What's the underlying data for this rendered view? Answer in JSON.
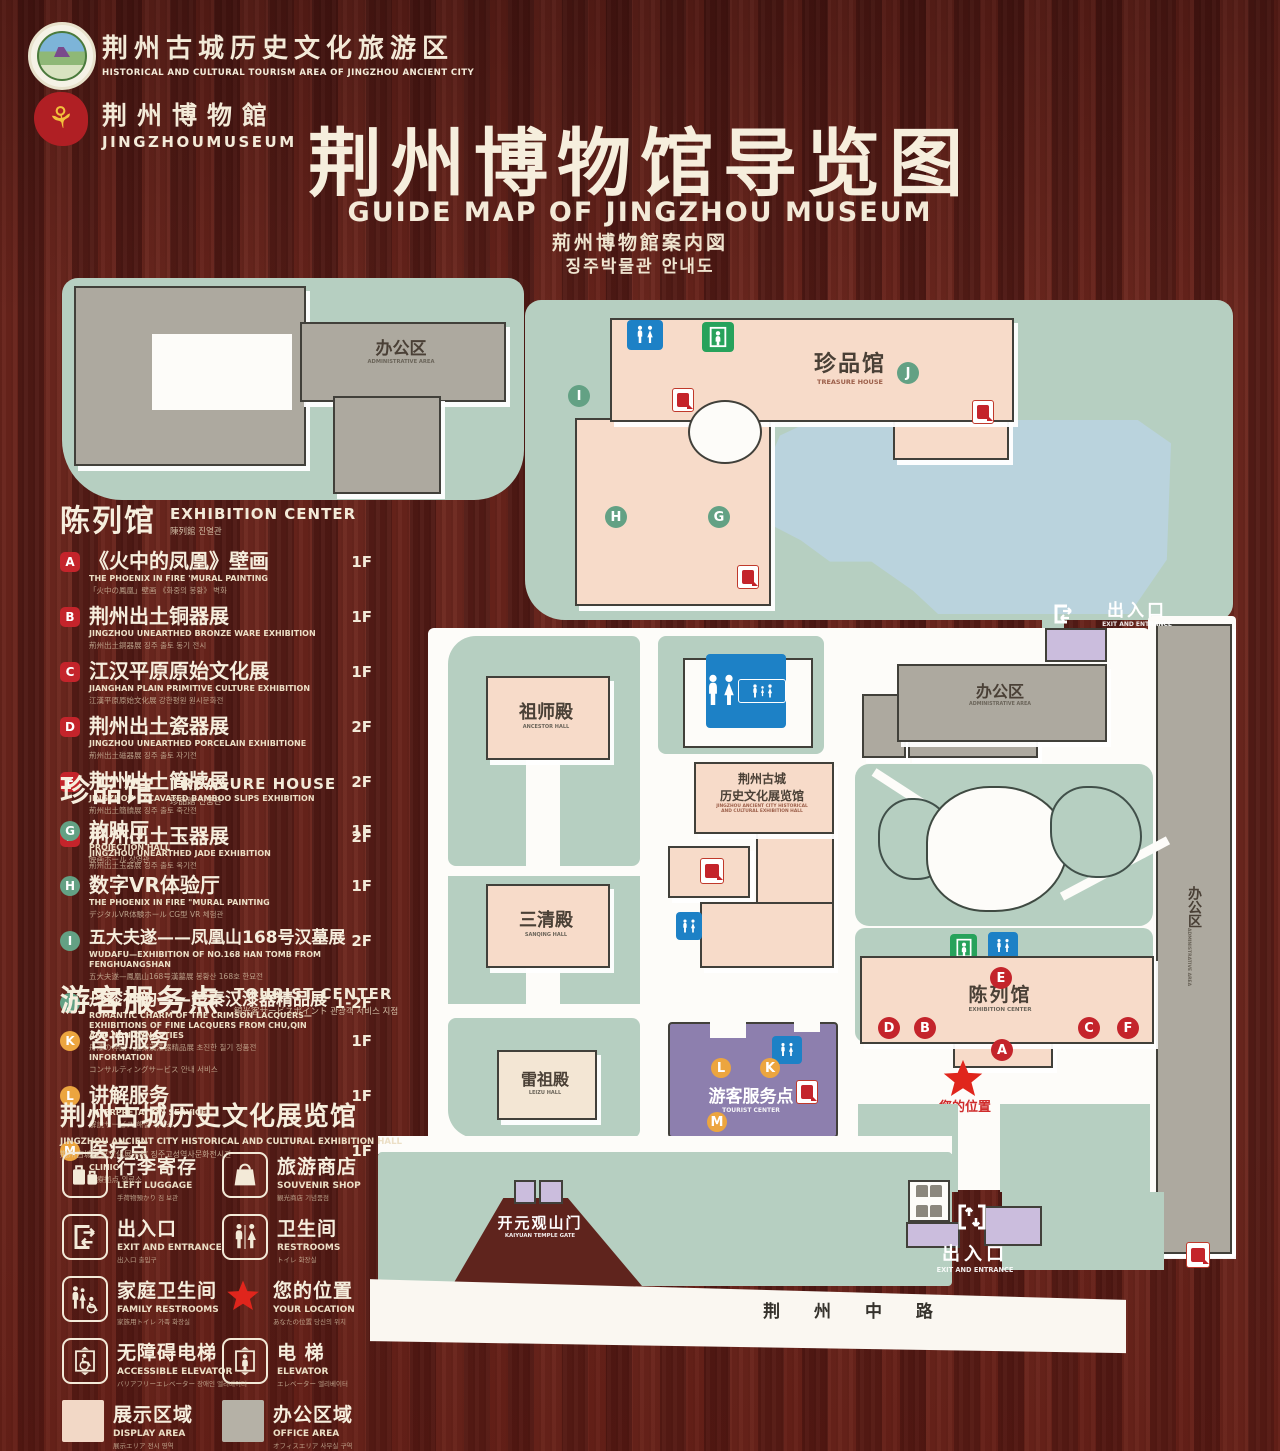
{
  "header": {
    "logo1": {
      "zh": "荆州古城历史文化旅游区",
      "en": "HISTORICAL AND CULTURAL TOURISM AREA OF JINGZHOU ANCIENT CITY"
    },
    "logo2": {
      "zh": "荆州博物館",
      "en": "JINGZHOUMUSEUM"
    },
    "title_zh": "荆州博物馆导览图",
    "title_en": "GUIDE MAP OF JINGZHOU MUSEUM",
    "title_ja": "荊州博物館案内図",
    "title_ko": "징주박물관 안내도"
  },
  "sidebar": {
    "sections": [
      {
        "zh": "陈列馆",
        "en": "EXHIBITION CENTER",
        "sub": "陳列館  진열관",
        "items": [
          {
            "id": "A",
            "zh": "《火中的凤凰》壁画",
            "en": "THE PHOENIX IN FIRE 'MURAL PAINTING",
            "sub": "「火中の鳳凰」壁画 《화중의 봉황》 벽화",
            "floor": "1F"
          },
          {
            "id": "B",
            "zh": "荆州出土铜器展",
            "en": "JINGZHOU UNEARTHED BRONZE WARE EXHIBITION",
            "sub": "荊州出土銅器展  징주 출토 동기 전시",
            "floor": "1F"
          },
          {
            "id": "C",
            "zh": "江汉平原原始文化展",
            "en": "JIANGHAN PLAIN PRIMITIVE CULTURE EXHIBITION",
            "sub": "江漢平原原始文化展  강한평원 원시문화전",
            "floor": "1F"
          },
          {
            "id": "D",
            "zh": "荆州出土瓷器展",
            "en": "JINGZHOU UNEARTHED PORCELAIN EXHIBITIONE",
            "sub": "荊州出土磁器展  징주 출토 자기전",
            "floor": "2F"
          },
          {
            "id": "E",
            "zh": "荆州出土简牍展",
            "en": "JINGZHOU EXCAVATED BAMBOO SLIPS EXHIBITION",
            "sub": "荊州出土簡牘展  징주 출토 죽간전",
            "floor": "2F"
          },
          {
            "id": "F",
            "zh": "荆州出土玉器展",
            "en": "JINGZHOU UNEARTHED JADE EXHIBITION",
            "sub": "荊州出土玉器展  징주 출토 옥기전",
            "floor": "2F"
          }
        ]
      },
      {
        "zh": "珍品馆",
        "en": "TREASURE HOUSE",
        "sub": "珍品館  진품관",
        "items": [
          {
            "id": "G",
            "zh": "放映厅",
            "en": "PROJECTION HALL",
            "sub": "映画ホール  상영관",
            "floor": "1F"
          },
          {
            "id": "H",
            "zh": "数字VR体验厅",
            "en": "THE PHOENIX IN FIRE \"MURAL PAINTING",
            "sub": "デジタルVR体験ホール  CG型 VR 체험관",
            "floor": "1F"
          },
          {
            "id": "I",
            "zh": "五大夫遂——凤凰山168号汉墓展",
            "en": "WUDAFU—EXHIBITION OF NO.168 HAN TOMB FROM FENGHUANGSHAN",
            "sub": "五大夫遂—鳳凰山168号漢墓展  봉황산 168호 한묘전",
            "floor": "2F"
          },
          {
            "id": "J",
            "zh": "丹漆神韵——楚秦汉漆器精品展",
            "en": "ROMANTIC CHARM OF THE CRIMSON LACQUERS— EXHIBITIONS OF FINE LACQUERS FROM CHU,QIN AND HAN DYNASTIES",
            "sub": "丹漆の神韻—楚秦漢漆器精品展  초진한 칠기 정품전",
            "floor": "1-2F"
          }
        ]
      },
      {
        "zh": "游客服务点",
        "en": "TOURIST CENTER",
        "sub": "観光客サービスポイント  관광객 서비스 지점",
        "items": [
          {
            "id": "K",
            "zh": "咨询服务",
            "en": "INFORMATION",
            "sub": "コンサルティングサービス  안내 서비스",
            "floor": "1F"
          },
          {
            "id": "L",
            "zh": "讲解服务",
            "en": "INTERPRETATION SERVICE",
            "sub": "解説サービス  해설 서비스",
            "floor": "1F"
          },
          {
            "id": "M",
            "zh": "医疗点",
            "en": "CLINIC",
            "sub": "医療拠点  의료소",
            "floor": "1F"
          }
        ]
      }
    ],
    "hall_note": {
      "zh": "荆州古城历史文化展览馆",
      "en": "JINGZHOU ANCIENT CITY HISTORICAL AND CULTURAL EXHIBITION HALL",
      "sub": "荆州古城歴史文化展示館    징주고성역사문화전시관"
    },
    "legend": [
      {
        "zh": "行李寄存",
        "en": "LEFT LUGGAGE",
        "sub": "手荷物預かり  짐 보관"
      },
      {
        "zh": "旅游商店",
        "en": "SOUVENIR SHOP",
        "sub": "観光商店  기념품점"
      },
      {
        "zh": "出入口",
        "en": "EXIT AND ENTRANCE",
        "sub": "出入口  출입구"
      },
      {
        "zh": "卫生间",
        "en": "RESTROOMS",
        "sub": "トイレ  화장실"
      },
      {
        "zh": "家庭卫生间",
        "en": "FAMILY RESTROOMS",
        "sub": "家族用トイレ  가족 화장실"
      },
      {
        "zh": "您的位置",
        "en": "YOUR LOCATION",
        "sub": "あなたの位置  당신의 위치"
      },
      {
        "zh": "无障碍电梯",
        "en": "ACCESSIBLE ELEVATOR",
        "sub": "バリアフリーエレベーター  장애인 엘리베이터"
      },
      {
        "zh": "电  梯",
        "en": "ELEVATOR",
        "sub": "エレベーター  엘리베이터"
      },
      {
        "zh": "展示区域",
        "en": "DISPLAY AREA",
        "sub": "展示エリア  전시 영역"
      },
      {
        "zh": "办公区域",
        "en": "OFFICE AREA",
        "sub": "オフィスエリア  사무실 구역"
      }
    ]
  },
  "map": {
    "admin": {
      "zh": "办公区",
      "en": "ADMINISTRATIVE AREA"
    },
    "treasure_house": {
      "zh": "珍品馆",
      "en": "TREASURE HOUSE"
    },
    "ancestor_hall": {
      "zh": "祖师殿",
      "en": "ANCESTOR HALL"
    },
    "sanqing_hall": {
      "zh": "三清殿",
      "en": "SANQING HALL"
    },
    "leizu_hall": {
      "zh": "雷祖殿",
      "en": "LEIZU HALL"
    },
    "exhibition_hall": {
      "zh1": "荆州古城",
      "zh2": "历史文化展览馆",
      "en1": "JINGZHOU ANCIENT CITY HISTORICAL",
      "en2": "AND CULTURAL EXHIBITION HALL"
    },
    "tourist_center": {
      "zh": "游客服务点",
      "en": "TOURIST CENTER"
    },
    "exhibition_center": {
      "zh": "陈列馆",
      "en": "EXHIBITION CENTER"
    },
    "kaiyuan_gate": {
      "zh": "开元观山门",
      "en": "KAIYUAN TEMPLE GATE"
    },
    "exit": {
      "zh": "出入口",
      "en": "EXIT AND ENTRANCE"
    },
    "your_location": {
      "zh": "您的位置"
    },
    "road": {
      "zh": "荆 州 中 路"
    }
  }
}
